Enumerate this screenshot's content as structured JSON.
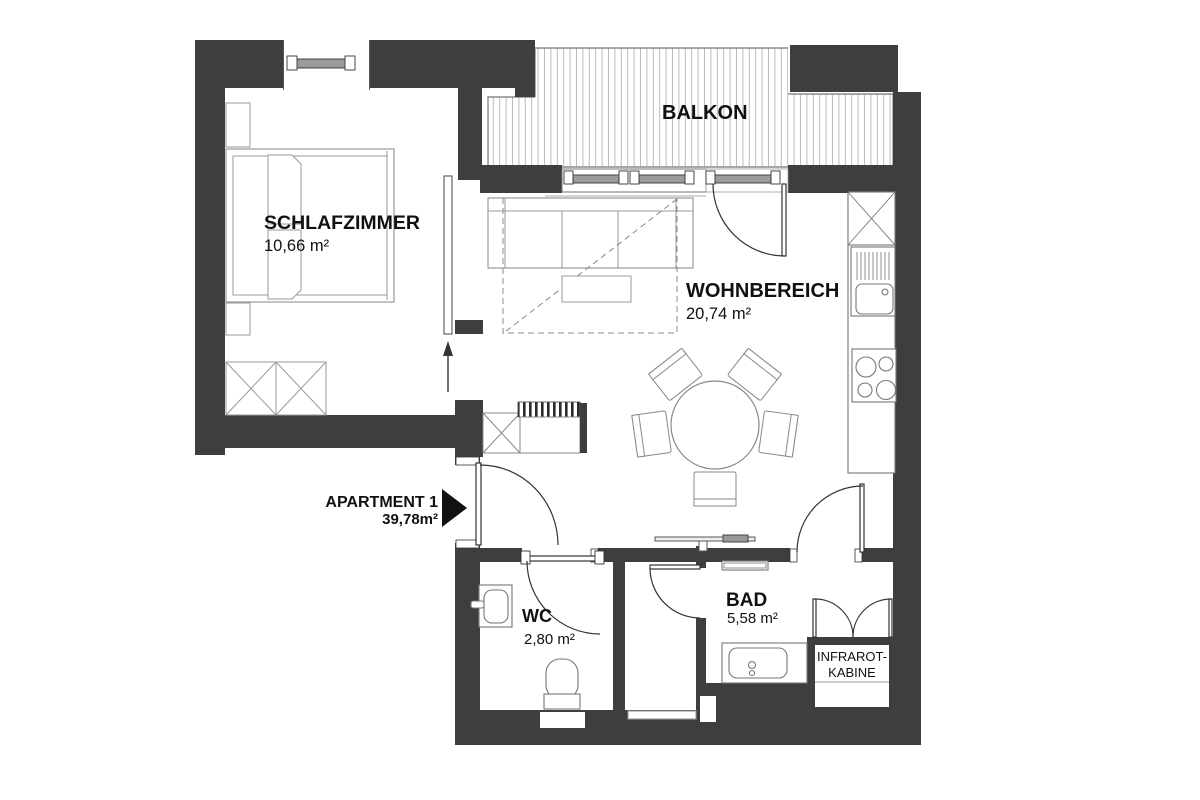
{
  "document": {
    "type": "apartment-floor-plan"
  },
  "colors": {
    "wall": "#3e3e3e",
    "furniture_line": "#939393",
    "fixture_line": "#777777",
    "door_line": "#333333",
    "deck_stripe": "#bcbcbc",
    "text": "#111111"
  },
  "rooms": {
    "schlafzimmer": {
      "name": "SCHLAFZIMMER",
      "area": "10,66 m²"
    },
    "balkon": {
      "name": "BALKON"
    },
    "wohnbereich": {
      "name": "WOHNBEREICH",
      "area": "20,74 m²"
    },
    "wc": {
      "name": "WC",
      "area": "2,80 m²"
    },
    "bad": {
      "name": "BAD",
      "area": "5,58 m²"
    },
    "infrarot_kabine": {
      "line1": "INFRAROT-",
      "line2": "KABINE"
    }
  },
  "entrance": {
    "label": "APARTMENT 1",
    "area": "39,78m²"
  }
}
